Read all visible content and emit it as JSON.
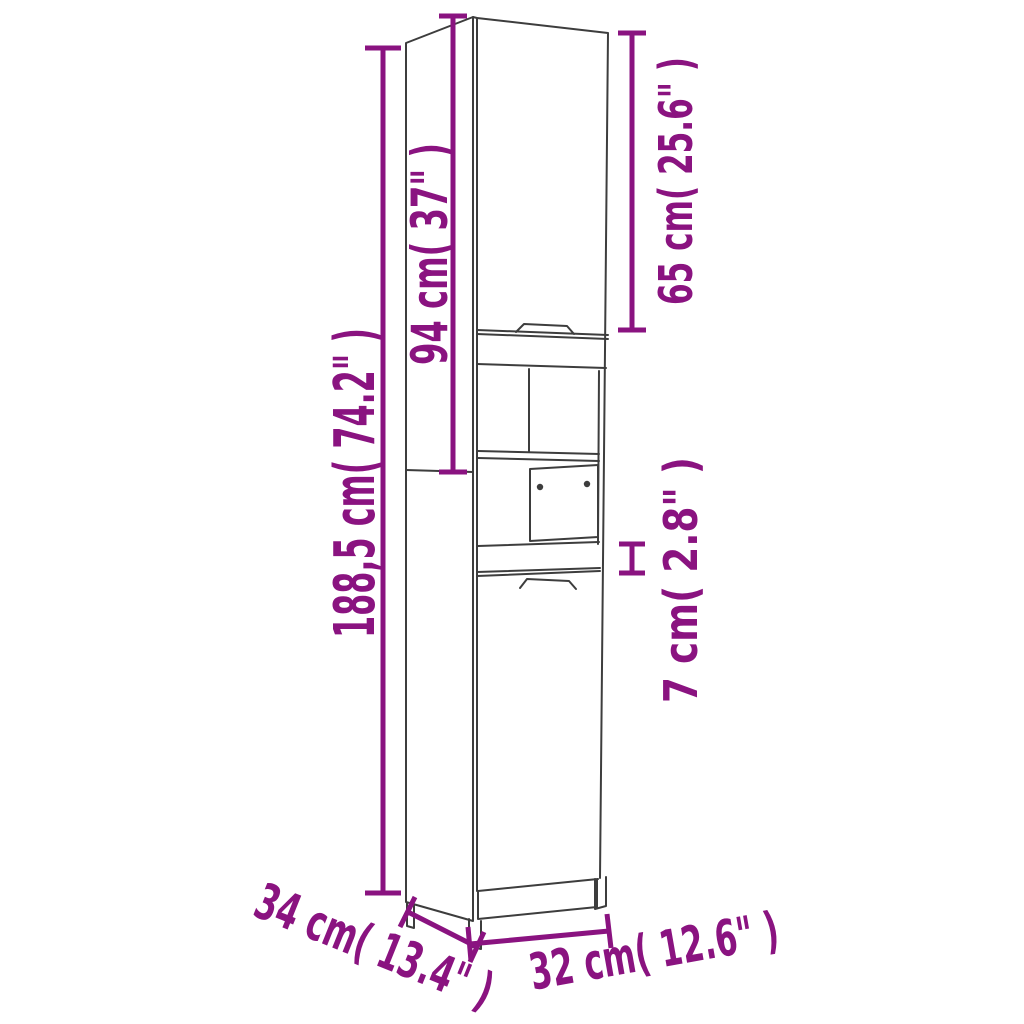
{
  "diagram": {
    "subject": "tall bathroom cabinet line drawing with dimension annotations",
    "colors": {
      "annotation": "#8a1380",
      "line_art": "#3d3d3d",
      "background": "#ffffff"
    },
    "dimensions": {
      "total_height": {
        "label": "188,5 cm( 74.2\" )",
        "cm": "188,5",
        "inches": "74.2"
      },
      "upper_section_height": {
        "label": "94 cm( 37\" )",
        "cm": "94",
        "inches": "37"
      },
      "top_door_height": {
        "label": "65 cm( 25.6\" )",
        "cm": "65",
        "inches": "25.6"
      },
      "drawer_front_height": {
        "label": "7 cm( 2.8\" )",
        "cm": "7",
        "inches": "2.8"
      },
      "depth": {
        "label": "34 cm( 13.4\" )",
        "cm": "34",
        "inches": "13.4"
      },
      "width": {
        "label": "32 cm( 12.6\" )",
        "cm": "32",
        "inches": "12.6"
      }
    }
  }
}
